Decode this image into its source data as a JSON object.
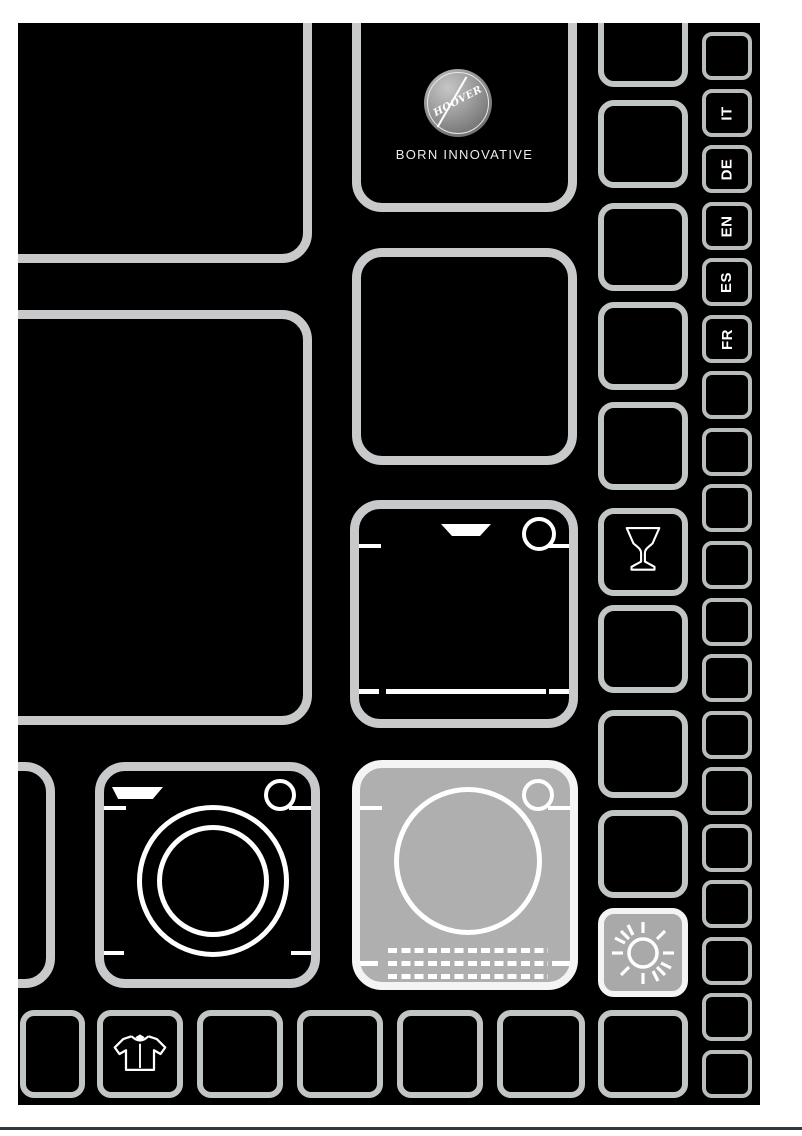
{
  "brand": {
    "logo_text": "HOOVER",
    "tagline": "BORN INNOVATIVE"
  },
  "languages": [
    "IT",
    "DE",
    "EN",
    "ES",
    "FR"
  ],
  "colors": {
    "page_bg": "#ffffff",
    "cover_bg": "#000000",
    "tile_border_large": "#c7c9ca",
    "tile_border_small": "#b9bcbd",
    "highlight_tile_bg": "#afafaf",
    "icon_stroke": "#ffffff",
    "footer_line": "#333940",
    "logo_sphere": "#9a9a9a",
    "tagline_color": "#ececec"
  },
  "icons": {
    "wine_glass": "wine-glass-icon",
    "sun": "sun-icon",
    "dishwasher": "dishwasher-icon",
    "washing_machine": "washing-machine-icon",
    "tumble_dryer": "tumble-dryer-icon",
    "shirt": "shirt-icon"
  }
}
